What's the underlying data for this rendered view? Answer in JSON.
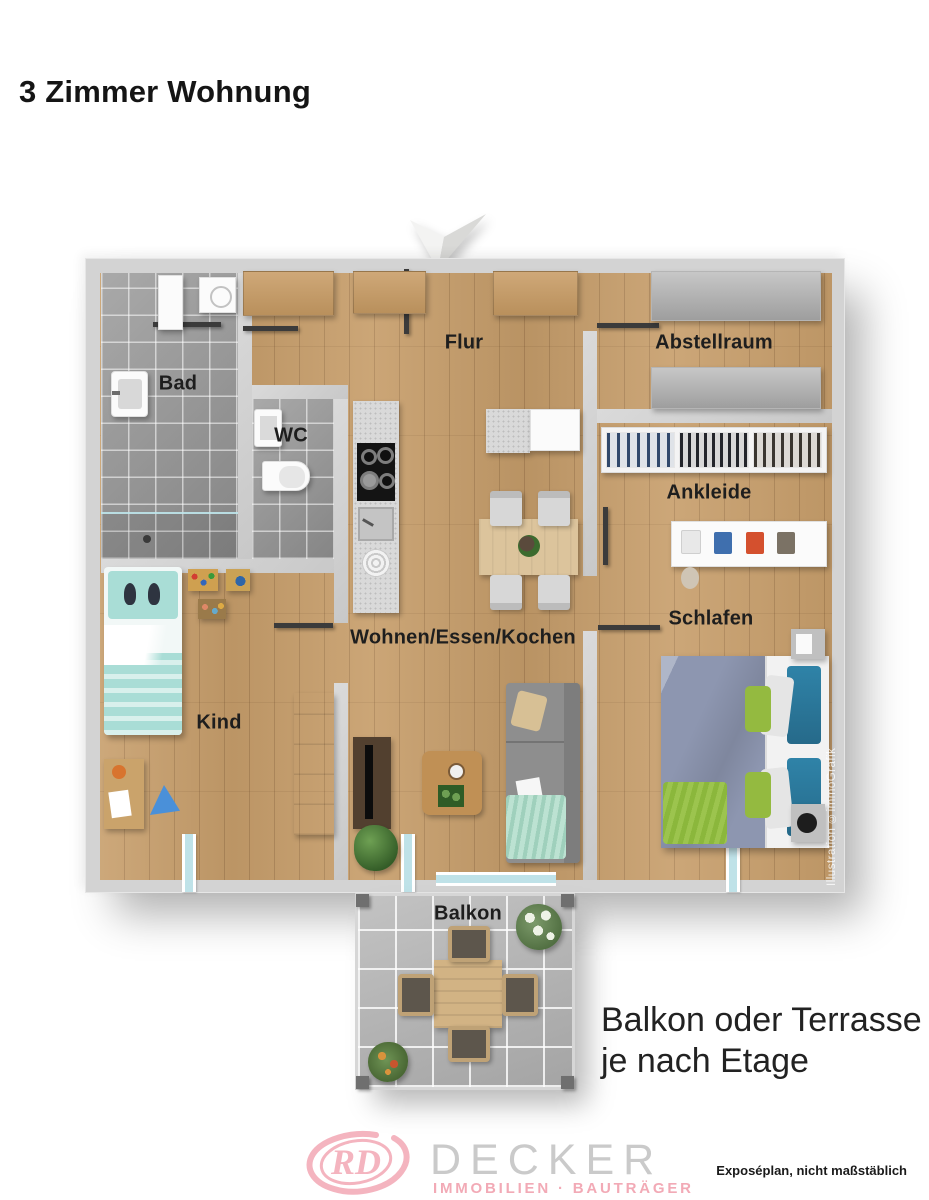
{
  "page_title": "3 Zimmer Wohnung",
  "rooms": {
    "flur": "Flur",
    "abstellraum": "Abstellraum",
    "bad": "Bad",
    "wc": "WC",
    "ankleide": "Ankleide",
    "schlafen": "Schlafen",
    "kind": "Kind",
    "wohnen": "Wohnen/Essen/Kochen",
    "balkon": "Balkon"
  },
  "watermark": "Illustration ©immoGrafik",
  "annotation": {
    "line1": "Balkon oder Terrasse",
    "line2": "je nach Etage"
  },
  "footer": {
    "monogram": "RD",
    "brand": "DECKER",
    "brand_subtitle": "IMMOBILIEN · BAUTRÄGER",
    "disclaimer": "Exposéplan, nicht maßstäblich"
  },
  "icons": {
    "north_arrow": "compass-arrow-down"
  },
  "colors": {
    "wall": "#d3d3d3",
    "wood_floor": "#c79e6b",
    "tile_gray": "#9b9b9b",
    "balcony_tile": "#b7b7b7",
    "glass": "#bfe2e8",
    "logo_pink": "#f4b4bf",
    "logo_gray": "#cacaca",
    "bed_duvet": "#8d96b0",
    "accent_green": "#94ba40",
    "accent_teal": "#2f83a8",
    "kid_mint": "#a9ddd6"
  }
}
